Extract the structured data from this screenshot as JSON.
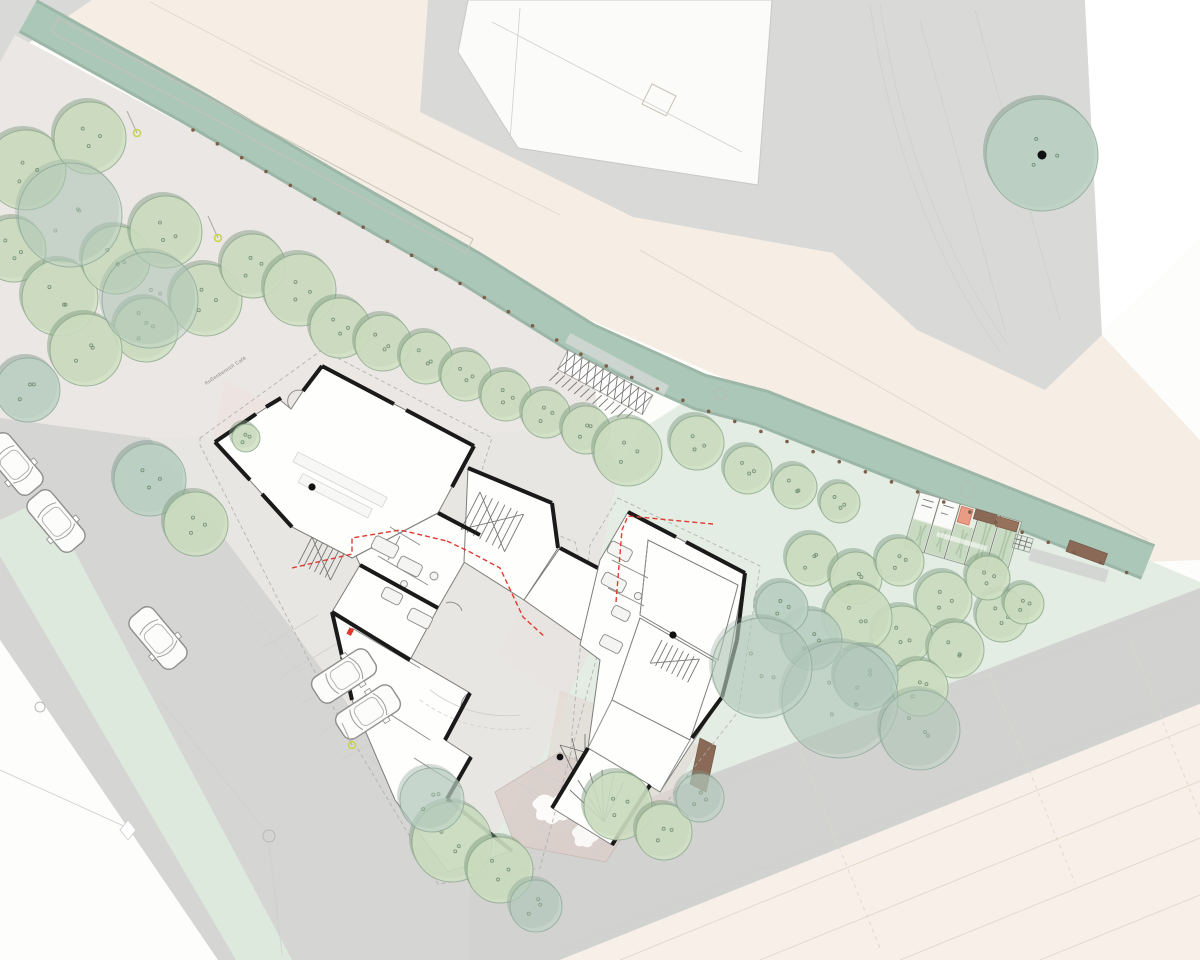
{
  "title": "Architectural site plan – ground floor with landscaping",
  "labels": {
    "cafe_outdoor_area": "Außenbereich Café"
  },
  "palette": {
    "cream": "#f6eee5",
    "cream2": "#f8f0e8",
    "gray": "#d9dad8",
    "grayRoad": "#d5d6d4",
    "grayBand": "#d2d3d1",
    "park": "#eae7e4",
    "plaza": "#e8e6e3",
    "garden": "#e3ede4",
    "verge": "#dde9dd",
    "canal": "#abc7b8",
    "canalEdge": "#9cb6a8",
    "treeA": "#cfdfc2",
    "treeAEdge": "#8ba88a",
    "treeAShadow": "#7e9a7e",
    "treeB": "#bdd2c4",
    "treeBEdge": "#90a99b",
    "treeBShadow": "#7f998c",
    "wall": "#1a1a1a",
    "red": "#e23a2e",
    "brown": "#8a6a57",
    "lamp": "#c8d44e"
  },
  "trees": [
    [
      26,
      170,
      40,
      "a"
    ],
    [
      90,
      138,
      36,
      "a"
    ],
    [
      14,
      250,
      32,
      "a"
    ],
    [
      60,
      298,
      38,
      "a"
    ],
    [
      116,
      260,
      34,
      "a"
    ],
    [
      166,
      232,
      36,
      "a"
    ],
    [
      206,
      300,
      36,
      "a"
    ],
    [
      146,
      330,
      32,
      "a"
    ],
    [
      86,
      350,
      36,
      "a"
    ],
    [
      28,
      390,
      32,
      "b"
    ],
    [
      253,
      266,
      32,
      "a"
    ],
    [
      300,
      290,
      36,
      "a"
    ],
    [
      340,
      328,
      30,
      "a"
    ],
    [
      383,
      343,
      28,
      "a"
    ],
    [
      426,
      358,
      26,
      "a"
    ],
    [
      466,
      376,
      25,
      "a"
    ],
    [
      506,
      396,
      25,
      "a"
    ],
    [
      546,
      414,
      24,
      "a"
    ],
    [
      586,
      430,
      24,
      "a"
    ],
    [
      70,
      215,
      52,
      "b",
      0.45
    ],
    [
      150,
      300,
      48,
      "b",
      0.45
    ],
    [
      628,
      452,
      34,
      "a"
    ],
    [
      697,
      443,
      27,
      "a"
    ],
    [
      748,
      470,
      24,
      "a"
    ],
    [
      795,
      487,
      22,
      "a"
    ],
    [
      840,
      503,
      20,
      "a"
    ],
    [
      150,
      480,
      36,
      "b"
    ],
    [
      196,
      524,
      32,
      "a"
    ],
    [
      246,
      438,
      14,
      "a"
    ],
    [
      812,
      560,
      26,
      "a"
    ],
    [
      856,
      578,
      26,
      "a"
    ],
    [
      900,
      562,
      24,
      "a"
    ],
    [
      944,
      600,
      28,
      "a"
    ],
    [
      902,
      636,
      30,
      "a"
    ],
    [
      858,
      618,
      34,
      "a"
    ],
    [
      956,
      650,
      28,
      "a"
    ],
    [
      1002,
      616,
      26,
      "a"
    ],
    [
      988,
      578,
      22,
      "a"
    ],
    [
      1024,
      604,
      20,
      "a"
    ],
    [
      920,
      688,
      28,
      "a"
    ],
    [
      866,
      678,
      32,
      "b"
    ],
    [
      812,
      640,
      30,
      "b"
    ],
    [
      782,
      608,
      26,
      "b"
    ],
    [
      840,
      700,
      58,
      "b",
      0.5
    ],
    [
      762,
      668,
      50,
      "b",
      0.5
    ],
    [
      920,
      730,
      40,
      "b",
      0.5
    ],
    [
      452,
      842,
      40,
      "a"
    ],
    [
      500,
      870,
      33,
      "a"
    ],
    [
      618,
      806,
      34,
      "a"
    ],
    [
      664,
      832,
      28,
      "a"
    ],
    [
      432,
      800,
      32,
      "b",
      0.6
    ],
    [
      536,
      906,
      26,
      "b",
      0.6
    ],
    [
      700,
      798,
      24,
      "b",
      0.6
    ],
    [
      1042,
      155,
      56,
      "b",
      0.9,
      true
    ]
  ],
  "cars": [
    {
      "x": 14,
      "y": 464,
      "rot": 50,
      "state": "driving"
    },
    {
      "x": 56,
      "y": 521,
      "rot": 50,
      "state": "driving"
    },
    {
      "x": 158,
      "y": 638,
      "rot": 50,
      "state": "driving"
    },
    {
      "x": 344,
      "y": 676,
      "rot": -33,
      "state": "parked"
    },
    {
      "x": 368,
      "y": 712,
      "rot": -33,
      "state": "parked"
    }
  ],
  "lamps": [
    [
      137,
      133
    ],
    [
      218,
      238
    ],
    [
      352,
      745
    ]
  ],
  "fence_posts": {
    "path": [
      [
        193,
        130
      ],
      [
        330,
        208
      ],
      [
        468,
        288
      ],
      [
        584,
        356
      ],
      [
        700,
        408
      ],
      [
        1146,
        580
      ]
    ],
    "spacing": 28
  },
  "bike_rack": {
    "stands": 13
  },
  "garden_beds": {
    "strips": 5,
    "white_cells": 2,
    "marked_cell_color": "#e89c83",
    "benches": 3
  },
  "tram_platform": {
    "segments": 2
  }
}
